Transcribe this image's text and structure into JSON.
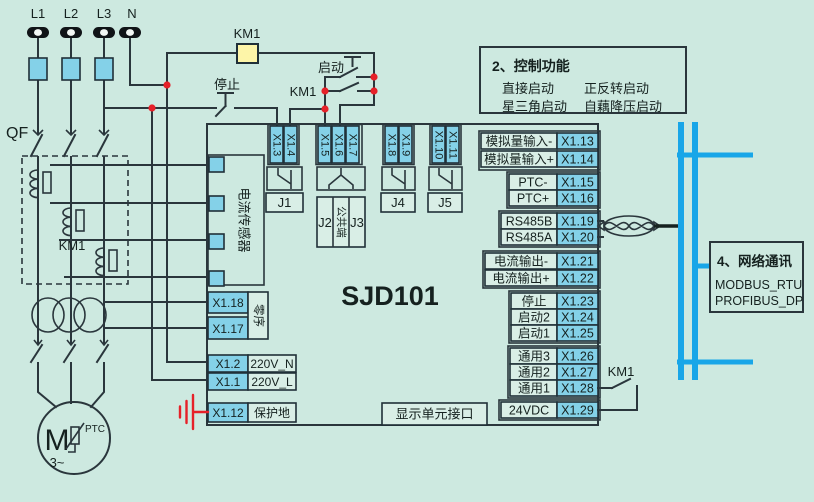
{
  "diagram": {
    "device_model": "SJD101",
    "power": {
      "terminals": [
        "L1",
        "L2",
        "L3",
        "N"
      ],
      "breaker": "QF"
    },
    "contactor": {
      "coil": "KM1",
      "main_label": "KM1",
      "aux_label": "KM1",
      "output_label": "KM1"
    },
    "buttons": {
      "stop": "停止",
      "start": "启动"
    },
    "motor": {
      "symbol": "M",
      "phase": "3~",
      "sensor": "PTC"
    },
    "current_sensor": "电流传感器",
    "display_port": "显示单元接口",
    "top_terminals": [
      "X1.3",
      "X1.4",
      "X1.5",
      "X1.6",
      "X1.7",
      "X1.8",
      "X1.9",
      "X1.10",
      "X1.11"
    ],
    "relays": {
      "j1": "J1",
      "j2": "J2",
      "j3": "J3",
      "j4": "J4",
      "j5": "J5",
      "common": "公共端"
    },
    "left_terminals": {
      "x18": "X1.18",
      "x17": "X1.17",
      "zero_seq": "零序",
      "x2": "X1.2",
      "n_label": "220V_N",
      "x1": "X1.1",
      "l_label": "220V_L",
      "x12": "X1.12",
      "pe_label": "保护地"
    },
    "right_rows": [
      {
        "label": "模拟量输入-",
        "id": "X1.13"
      },
      {
        "label": "模拟量输入+",
        "id": "X1.14"
      },
      {
        "label": "PTC-",
        "id": "X1.15"
      },
      {
        "label": "PTC+",
        "id": "X1.16"
      },
      {
        "label": "RS485B",
        "id": "X1.19"
      },
      {
        "label": "RS485A",
        "id": "X1.20"
      },
      {
        "label": "电流输出-",
        "id": "X1.21"
      },
      {
        "label": "电流输出+",
        "id": "X1.22"
      },
      {
        "label": "停止",
        "id": "X1.23"
      },
      {
        "label": "启动2",
        "id": "X1.24"
      },
      {
        "label": "启动1",
        "id": "X1.25"
      },
      {
        "label": "通用3",
        "id": "X1.26"
      },
      {
        "label": "通用2",
        "id": "X1.27"
      },
      {
        "label": "通用1",
        "id": "X1.28"
      },
      {
        "label": "24VDC",
        "id": "X1.29"
      }
    ],
    "control_box": {
      "title": "2、控制功能",
      "items": [
        "直接启动",
        "正反转启动",
        "星三角启动",
        "自藕降压启动"
      ]
    },
    "network_box": {
      "title": "4、网络通讯",
      "items": [
        "MODBUS_RTU",
        "PROFIBUS_DP"
      ]
    },
    "colors": {
      "background": "#cde9e0",
      "terminal_blue": "#84d1e8",
      "coil_yellow": "#fdf5a8",
      "bus_cyan": "#18a6e8",
      "junction_red": "#e62129",
      "line": "#2a363c"
    }
  }
}
